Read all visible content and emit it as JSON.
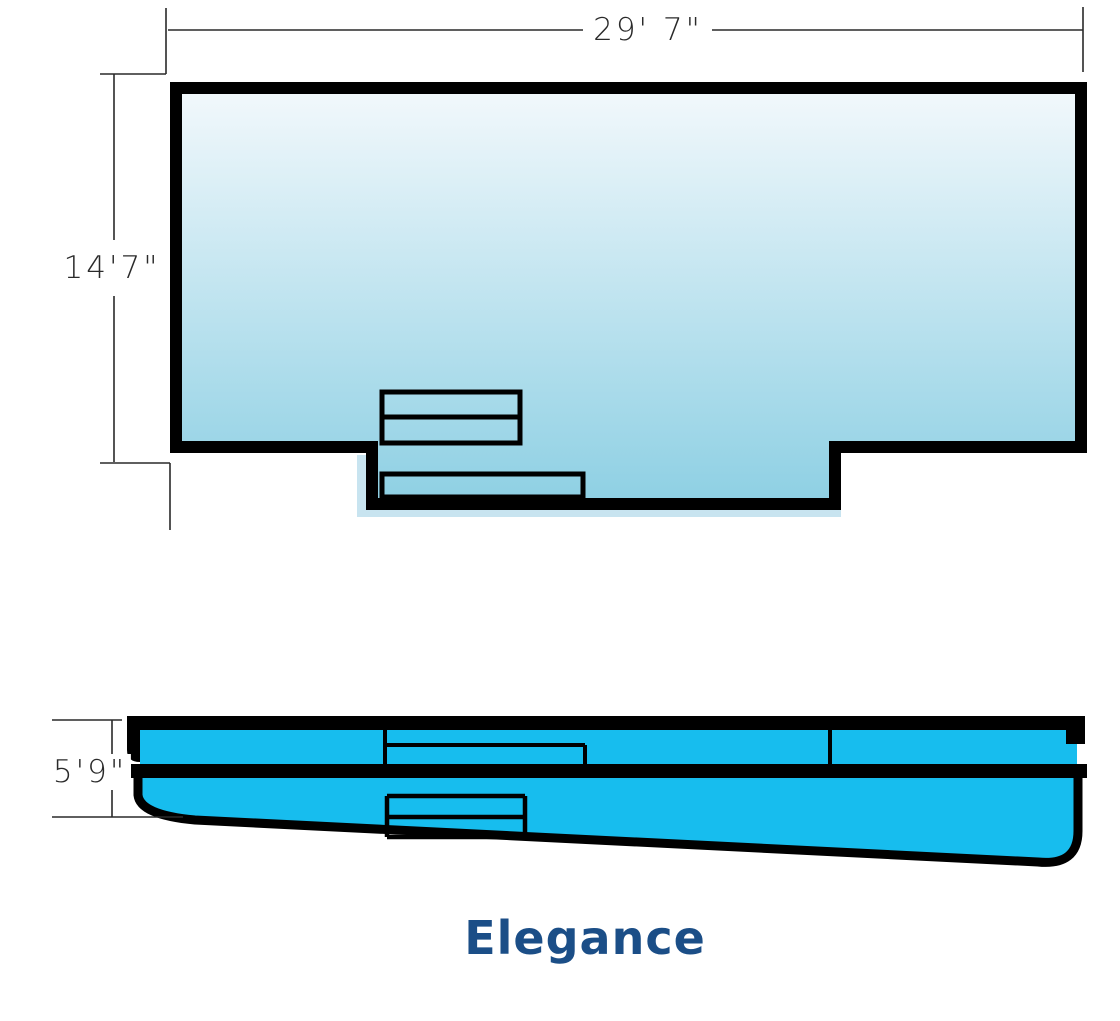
{
  "diagram": {
    "title": "Elegance",
    "top_view": {
      "description": "pool plan view with entry steps and tanning ledge",
      "width_dim": "29' 7\"",
      "height_dim": "14'7\""
    },
    "side_view": {
      "description": "pool depth profile, shallow end left sloping to deep end right",
      "depth_dim": "5'9\""
    }
  },
  "colors": {
    "pool_grad_top": "#f4f9fc",
    "pool_grad_bottom": "#8ccfe3",
    "side_fill": "#17bdee",
    "outline": "#000000",
    "title_color": "#1b4e87",
    "dim_color": "#2a2a2a",
    "shadow_color": "#c8e4f0"
  }
}
